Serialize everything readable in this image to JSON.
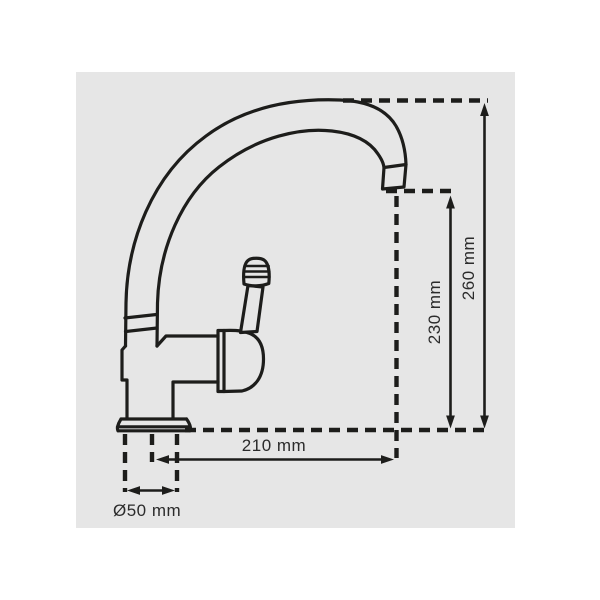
{
  "drawing": {
    "subject": "single-lever kitchen mixer tap, side elevation, dimensioned technical drawing",
    "colors": {
      "page_background": "#ffffff",
      "panel_background": "#e6e6e6",
      "line": "#1d1d1b",
      "text": "#2b2b2b"
    }
  },
  "dimensions": {
    "total_height": {
      "label": "260 mm"
    },
    "spout_height": {
      "label": "230 mm"
    },
    "spout_reach": {
      "label": "210 mm"
    },
    "base_diameter": {
      "label": "Ø50 mm"
    }
  }
}
